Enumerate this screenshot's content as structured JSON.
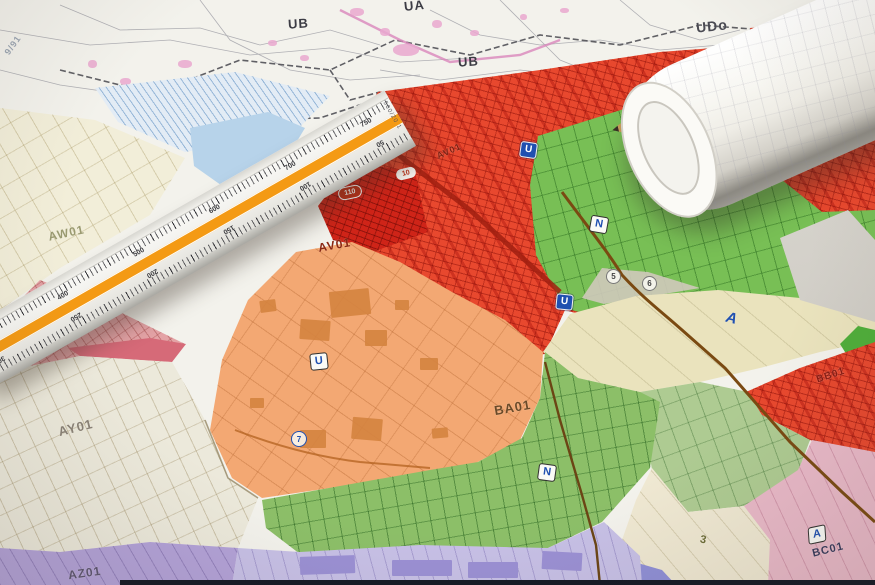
{
  "scene": {
    "description": "Photograph of colored urban zoning plans with a triangular scale ruler and a rolled map sheet"
  },
  "palette": {
    "red_zone": "#e8482e",
    "dark_red_zone": "#cf2418",
    "orange_zone": "#f3a873",
    "green_zone": "#78bf55",
    "bottom_green_zone": "#8cbf68",
    "sage_zone": "#aecb92",
    "cream_zone": "#eae3bd",
    "pink_zone": "#e9b9c8",
    "lavender_zone": "#c7c0e6",
    "purple_zone": "#b3a2d8",
    "badge_blue": "#2050b0",
    "ruler_stripe_orange": "#f49a14"
  },
  "top_map": {
    "label_ua": "UA",
    "label_ub_left": "UB",
    "label_ub_right": "UB",
    "label_udo": "UDo",
    "map_ref": "9/91"
  },
  "zones": {
    "aw01": "AW01",
    "av01": "AV01",
    "av01_small": "AV01",
    "ay01": "AY01",
    "az01": "AZ01",
    "ba01": "BA01",
    "bb01": "BB01",
    "bc01": "BC01"
  },
  "badges": {
    "u": "U",
    "n": "N",
    "a": "A",
    "pill_small": "10",
    "pill_large": "110",
    "circle_left": "5",
    "circle_right": "6",
    "circle_orange": "7",
    "plot_number": "3"
  },
  "ruler": {
    "top_scale": [
      "300",
      "400",
      "500",
      "600",
      "700",
      "750"
    ],
    "bottom_scale": [
      "300",
      "250",
      "200",
      "150",
      "100",
      "50"
    ],
    "end_mark": "500/20 1"
  }
}
